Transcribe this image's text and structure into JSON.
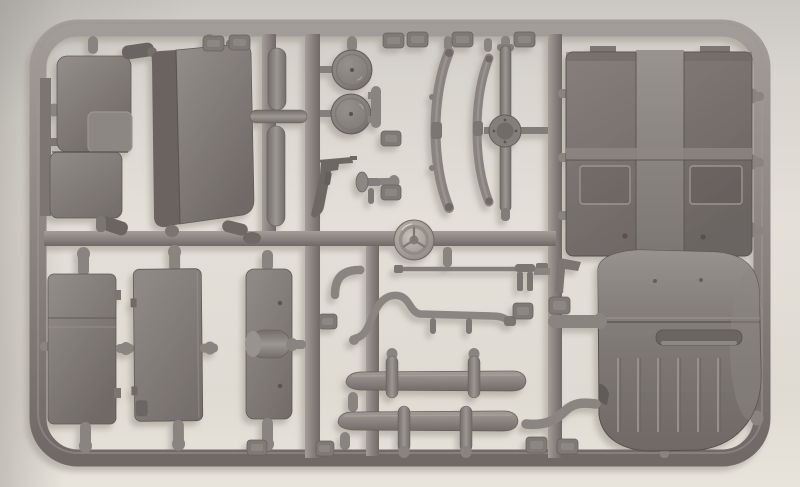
{
  "photo": {
    "description": "Photograph of a gray injection-molded plastic model kit sprue (parts tree) lying on a light gray surface",
    "alt": "Model kit sprue frame holding unpainted gray vehicle parts"
  },
  "palette": {
    "surface": "#dcd8d1",
    "surface_light": "#e9e5de",
    "surface_dark": "#c6c2bd",
    "plastic": "#8b8481",
    "plastic_light": "#a29c98",
    "plastic_dark": "#6e6764",
    "plastic_darker": "#5e5855",
    "cast_shadow": "#b1aca4"
  },
  "parts": {
    "frame": {
      "name": "sprue outer frame"
    },
    "runners": {
      "name": "internal runner bars"
    },
    "bench_seat": {
      "name": "bench seat"
    },
    "folded_seat": {
      "name": "folded seat back panel"
    },
    "cylinders": {
      "name": "cylindrical stowage rolls"
    },
    "wheel_disc_1": {
      "name": "wheel disc"
    },
    "wheel_disc_2": {
      "name": "wheel disc"
    },
    "submachine_gun": {
      "name": "submachine gun"
    },
    "lever": {
      "name": "lever with knob"
    },
    "steering_wheel": {
      "name": "steering wheel"
    },
    "leaf_spring_1": {
      "name": "curved leaf spring"
    },
    "leaf_spring_2": {
      "name": "curved leaf spring"
    },
    "front_axle": {
      "name": "axle with differential housing"
    },
    "floor_pan": {
      "name": "floor pan with transmission tunnel"
    },
    "hood": {
      "name": "rounded hood panel with ribs and handle recess"
    },
    "panel_a": {
      "name": "body side panel"
    },
    "panel_b": {
      "name": "body side panel"
    },
    "panel_c": {
      "name": "narrow panel with center bulge"
    },
    "tie_rod": {
      "name": "tie rod"
    },
    "elbow_pipe": {
      "name": "elbow pipe"
    },
    "exhaust_pipe": {
      "name": "exhaust pipe with hangers"
    },
    "clip_bracket": {
      "name": "two-prong clip bracket"
    },
    "angle_bracket": {
      "name": "angle bracket"
    },
    "bumper_upper": {
      "name": "bumper with overriders"
    },
    "bumper_lower": {
      "name": "bumper with overriders"
    },
    "exhaust_elbow": {
      "name": "curved connector pipe"
    },
    "gate_tabs": {
      "name": "molding gate tabs"
    },
    "stubs": {
      "name": "connector stubs"
    }
  }
}
